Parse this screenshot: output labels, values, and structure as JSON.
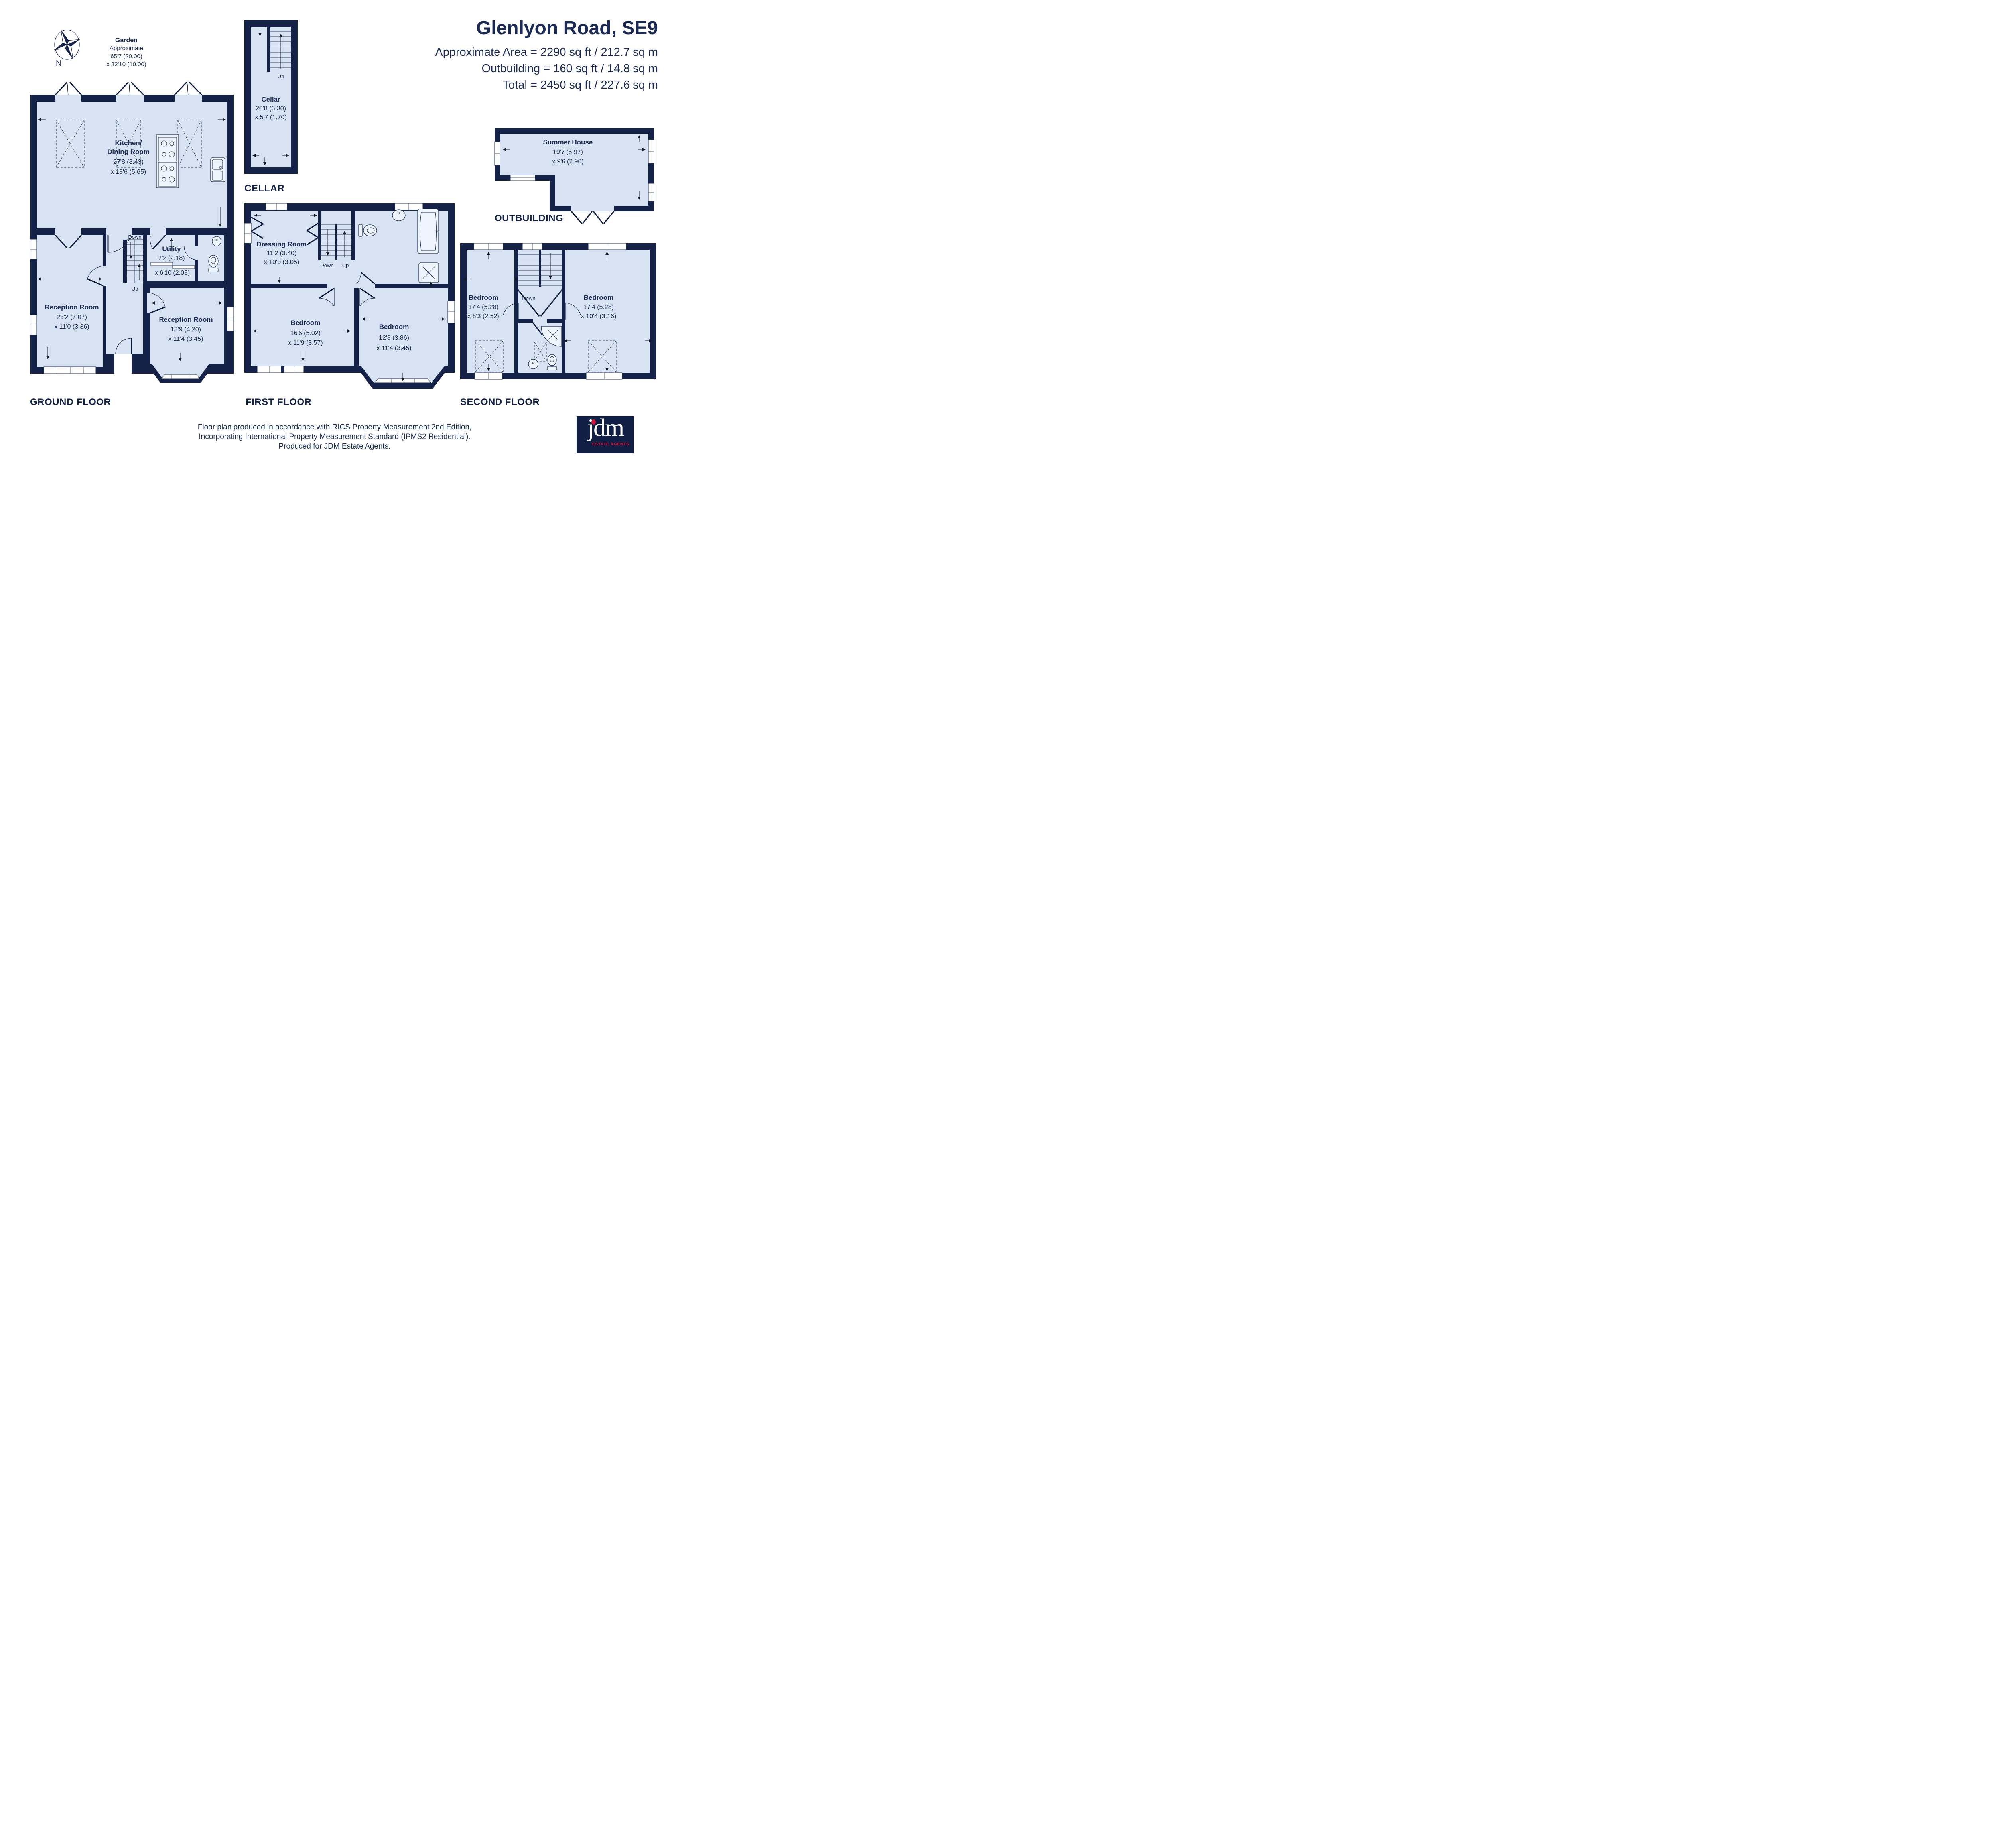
{
  "page": {
    "title": "Glenlyon Road, SE9",
    "area_line1": "Approximate Area = 2290 sq ft /  212.7 sq m",
    "area_line2": "Outbuilding = 160 sq ft / 14.8 sq m",
    "area_line3": "Total = 2450 sq ft / 227.6 sq m"
  },
  "compass": {
    "label": "N"
  },
  "garden": {
    "line1": "Garden",
    "line2": "Approximate",
    "line3": "65'7 (20.00)",
    "line4": "x 32'10 (10.00)"
  },
  "sections": {
    "ground": "GROUND FLOOR",
    "first": "FIRST FLOOR",
    "second": "SECOND FLOOR",
    "cellar": "CELLAR",
    "outbuilding": "OUTBUILDING"
  },
  "rooms": {
    "kitchen": {
      "line1": "Kitchen/",
      "line2": "Dining Room",
      "dim1": "27'8 (8.43)",
      "dim2": "x 18'6 (5.65)"
    },
    "utility": {
      "name": "Utility",
      "dim1": "7'2 (2.18)",
      "dim2": "x 6'10 (2.08)"
    },
    "reception1": {
      "name": "Reception Room",
      "dim1": "23'2 (7.07)",
      "dim2": "x 11'0 (3.36)"
    },
    "reception2": {
      "name": "Reception Room",
      "dim1": "13'9 (4.20)",
      "dim2": "x 11'4 (3.45)"
    },
    "cellar": {
      "name": "Cellar",
      "dim1": "20'8 (6.30)",
      "dim2": "x 5'7 (1.70)"
    },
    "dressing": {
      "name": "Dressing Room",
      "dim1": "11'2 (3.40)",
      "dim2": "x 10'0 (3.05)"
    },
    "bedroom1": {
      "name": "Bedroom",
      "dim1": "16'6 (5.02)",
      "dim2": "x 11'9 (3.57)"
    },
    "bedroom2": {
      "name": "Bedroom",
      "dim1": "12'8 (3.86)",
      "dim2": "x 11'4 (3.45)"
    },
    "bedroom3": {
      "name": "Bedroom",
      "dim1": "17'4 (5.28)",
      "dim2": "x 8'3 (2.52)"
    },
    "bedroom4": {
      "name": "Bedroom",
      "dim1": "17'4 (5.28)",
      "dim2": "x 10'4 (3.16)"
    },
    "summer_house": {
      "name": "Summer House",
      "dim1": "19'7 (5.97)",
      "dim2": "x 9'6 (2.90)"
    }
  },
  "stairs": {
    "up": "Up",
    "down": "Down"
  },
  "footer": {
    "line1": "Floor plan produced in accordance with RICS Property Measurement 2nd Edition,",
    "line2": "Incorporating International Property Measurement Standard (IPMS2 Residential).",
    "line3": "Produced for JDM Estate Agents."
  },
  "logo": {
    "name": "jdm",
    "tagline": "ESTATE AGENTS"
  },
  "colors": {
    "wall": "#152248",
    "room": "#d7e3f3",
    "text": "#1b2a55",
    "logo_red": "#d5173e",
    "logo_bg": "#111f45"
  }
}
